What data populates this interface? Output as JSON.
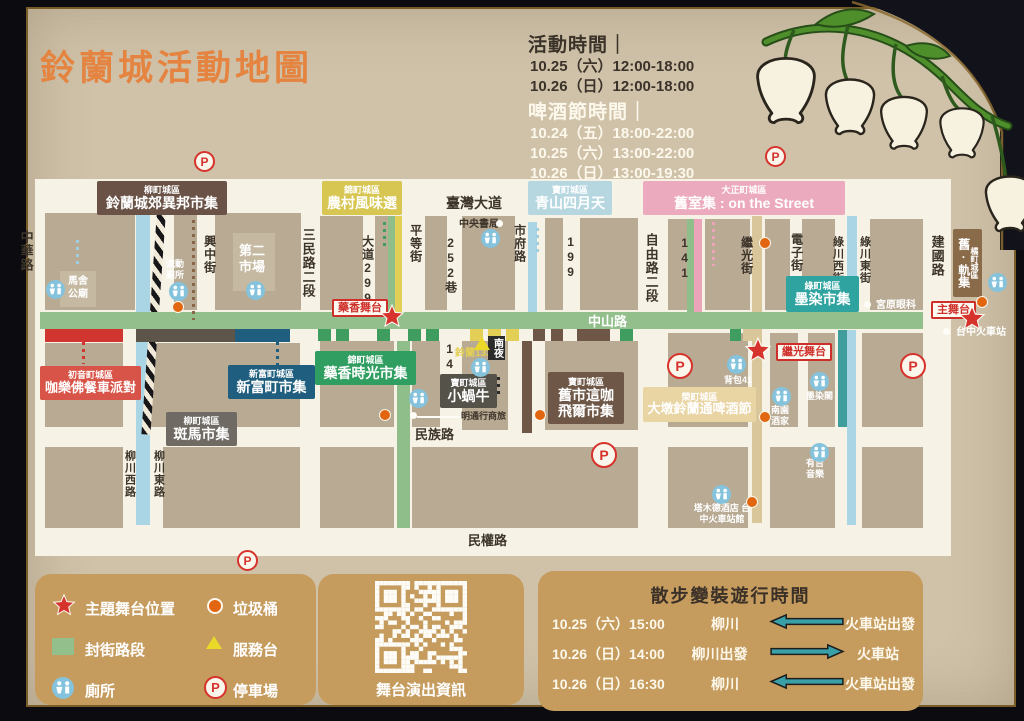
{
  "title": "鈴蘭城活動地圖",
  "schedule": {
    "event_heading": "活動時間｜",
    "event_lines": [
      "10.25（六）12:00-18:00",
      "10.26（日）12:00-18:00"
    ],
    "beer_heading": "啤酒節時間｜",
    "beer_lines": [
      "10.24（五）18:00-22:00",
      "10.25（六）13:00-22:00",
      "10.26（日）13:00-19:30"
    ]
  },
  "streets": {
    "zhonghua": "中華路",
    "xingzhong": "興中街",
    "sanmin": "三民路二段",
    "dadao299": "大道299",
    "pingdeng": "平等街",
    "lane252": "252巷",
    "taiwan_blvd": "臺灣大道",
    "shifu": "市府路",
    "n199": "199",
    "ziyou": "自由路二段",
    "n141": "141",
    "n143": "143",
    "jiguang": "繼光街",
    "dianzi": "電子街",
    "lvchuan_w": "綠川西街",
    "lvchuan_e": "綠川東街",
    "jianguo": "建國路",
    "zhongshan": "中山路",
    "minzu": "民族路",
    "minquan": "民權路",
    "liuchuan_w": "柳川西路",
    "liuchuan_e": "柳川東路"
  },
  "districts": {
    "yanagimachi": {
      "region": "柳町城區",
      "name": "鈴蘭城郊異邦市集"
    },
    "nishiki_farm": {
      "region": "錦町城區",
      "name": "農村風味選"
    },
    "takara_aoyama": {
      "region": "寶町城區",
      "name": "青山四月天"
    },
    "taisho": {
      "region": "大正町城區",
      "name": "舊室集 : on the Street"
    },
    "hatsune": {
      "region": "初音町城區",
      "name": "咖樂佛餐車派對"
    },
    "shinfu": {
      "region": "新富町城區",
      "name": "新富町市集"
    },
    "yanagimachi_zebra": {
      "region": "柳町城區",
      "name": "斑馬市集"
    },
    "nishiki_herb": {
      "region": "錦町城區",
      "name": "藥香時光市集"
    },
    "takara_snail": {
      "region": "寶町城區",
      "name": "小蝸牛"
    },
    "takara_cafe": {
      "region": "寶町城區",
      "name": "舊市這咖",
      "name2": "飛爾市集"
    },
    "midori": {
      "region": "綠町城區",
      "name": "墨染市集"
    },
    "sakae": {
      "region": "榮町城區",
      "name": "大墩鈴蘭通啤酒節"
    },
    "tachibana": {
      "region": "橘町城區",
      "name": "舊·軌集"
    }
  },
  "stages": {
    "herb": "藥香舞台",
    "jiguang": "繼光舞台",
    "main": "主舞台"
  },
  "poi": {
    "masha": "馬舍公廟",
    "mobile_toilet": "流動廁所",
    "market2": "第二市場",
    "bookstore": "中央書局",
    "suzuran133": "鈴蘭133",
    "nanye": "南夜",
    "hotel_mingtong": "明通行商旅",
    "miyahara": "宮原眼科",
    "station": "台中火車站",
    "backpack41": "背包41",
    "nanyuan": "南園酒家",
    "mozanke": "墨染閣",
    "youji": "有吉音樂",
    "tamude": "塔木德酒店 台中火車站館"
  },
  "legend": {
    "stage": "主題舞台位置",
    "trash": "垃圾桶",
    "closed": "封街路段",
    "service": "服務台",
    "toilet": "廁所",
    "parking": "停車場"
  },
  "icons": {
    "parking_letter": "P"
  },
  "qr_label": "舞台演出資訊",
  "parade": {
    "title": "散步變裝遊行時間",
    "rows": [
      {
        "datetime": "10.25（六）15:00",
        "from": "柳川",
        "dir": "left",
        "to": "火車站出發"
      },
      {
        "datetime": "10.26（日）14:00",
        "from": "柳川出發",
        "dir": "right",
        "to": "火車站"
      },
      {
        "datetime": "10.26（日）16:30",
        "from": "柳川",
        "dir": "left",
        "to": "火車站出發"
      }
    ]
  },
  "colors": {
    "paper": "#cfc2a9",
    "map_bg": "#f7f2e6",
    "block": "#b8aa93",
    "accent_orange": "#e58440",
    "closed_street": "#93bf8d",
    "river": "#aad5e5",
    "stage_red": "#d6332c",
    "legend_panel": "#c59c5e",
    "arrow_teal": "#3aa0a8"
  }
}
